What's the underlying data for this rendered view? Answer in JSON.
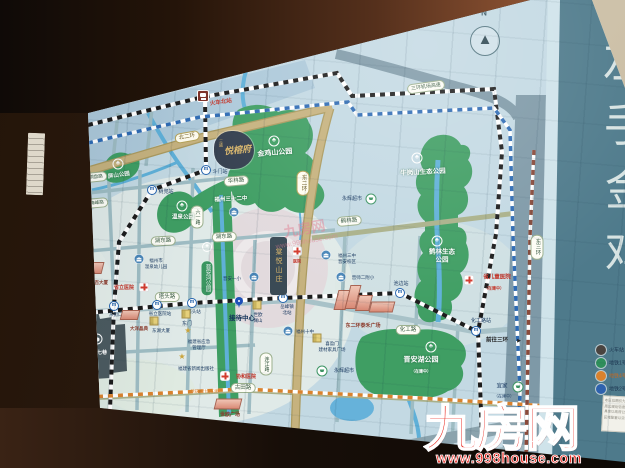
{
  "colors": {
    "map_bg": "#c3d9e3",
    "park_green": "#3f9e63",
    "road_gold": "#c6b27e",
    "road_grey": "#7e99a7",
    "river_blue": "#5fb0d8",
    "metro_black": "#1c1c1c",
    "metro_blue": "#2e6bb4",
    "metro_orange": "#d9822e",
    "metro_brown": "#8a4a3a",
    "watermark_red": "#e8251c",
    "panel_teal": "#4e7a8b",
    "project_gold": "#d8b56a"
  },
  "icons": {
    "park": "♣",
    "metro": "m",
    "star": "★",
    "needle": "▲",
    "arrow": "▶"
  },
  "compass": {
    "n": "N"
  },
  "parks": {
    "pingshan": "屏山公园",
    "zuohai": "左海公园",
    "xihu": "西湖公园",
    "jinjishan": "金鸡山公园",
    "wenquan": "温泉公园",
    "niugang": "牛岗山生态公园",
    "helin1": "鹤林生态",
    "helin2": "公园",
    "jinanhu": "晋安湖公园",
    "jinanhu_st": "（在建中）",
    "jinanhe": "晋安河公园"
  },
  "roads": {
    "beierhuan": "北二环",
    "dongerhuan": "东二环",
    "dongsanhuan": "东三环",
    "jichang": "三环机场高速",
    "helinlu": "鹤林路",
    "huagonglu": "化工路",
    "tatoulu": "塔头路",
    "hudonglu": "湖东路",
    "hudonglu2": "湖东路",
    "hualinlu": "华林路",
    "gutianlu": "古田路",
    "liuyilu": "六一路",
    "lianjianglu": "连江路",
    "tongpanlu": "铜盘路",
    "meifenglu": "梅峰路",
    "qianwang": "前往三环"
  },
  "stations": {
    "train_north": "火车北站",
    "doumen": "斗门站",
    "shudou": "树兜站",
    "dongjiekou": "东街口站",
    "shengli_sta": "省立医院站",
    "tatou": "塔头站",
    "yuefeng1": "岳峰镇",
    "yuefeng2": "北站",
    "chibian": "池边站",
    "huagong": "化工路站"
  },
  "schools": {
    "sanshierzhong": "福州三十二中",
    "sanzhong1": "福州三中",
    "sanzhong2": "晋安校区",
    "erfuxiao": "晋师二附小",
    "yixiao": "晋安一小",
    "shizhong": "福州十中",
    "kind1": "福州市",
    "kind2": "温泉幼儿园"
  },
  "pois": {
    "sanfang": "三坊七巷",
    "dongbai": "东百大厦",
    "dayang": "大洋晶典",
    "shengli_hosp": "省立医院",
    "taihe": "东二环泰禾广场",
    "shiou1": "世欧",
    "shiou2": "澜山",
    "yonghui": "永辉超市",
    "yonghui2": "永辉超市",
    "xiyingmen1": "喜盈门",
    "xiyingmen2": "建材家具广场",
    "yijia": "宜家",
    "yijia_st": "（在建中）",
    "shiou_plaza": "世欧广场",
    "yingji1": "福建省应急",
    "yingji2": "管理厅",
    "xinwen": "福建省新闻出版社",
    "xiehe": "协和医院",
    "dongmen": "东门",
    "donghu": "东湖大厦",
    "ertong": "省儿童医院",
    "ertong_st": "（在建中）",
    "hosp_r": "医院",
    "metro4_note": "地铁4号线(在建)"
  },
  "project": {
    "prefix": "三盛",
    "name": "悦榕府",
    "reception": "接待中心",
    "competitor": "棠悦山庄"
  },
  "panel": {
    "chars": [
      "左",
      "手",
      "金",
      "鸡"
    ]
  },
  "legend": {
    "items": [
      {
        "label": "火车站",
        "color": "#4a4440"
      },
      {
        "label": "地铁1号线",
        "color": "#2f8f5b"
      },
      {
        "label": "地铁4号线（在建）",
        "color": "#d9822e"
      },
      {
        "label": "地铁2号线",
        "color": "#2e62ae"
      }
    ],
    "disclaimer": [
      "本区位图仅为示意",
      "周边规划信息仅供参考",
      "具体以政府公示为准",
      "区域配套以实际为准"
    ]
  },
  "watermark": {
    "brand": "九房网",
    "url": "www.998house.com",
    "faint_brand": "九房网",
    "faint_url": "www.999house.com"
  }
}
